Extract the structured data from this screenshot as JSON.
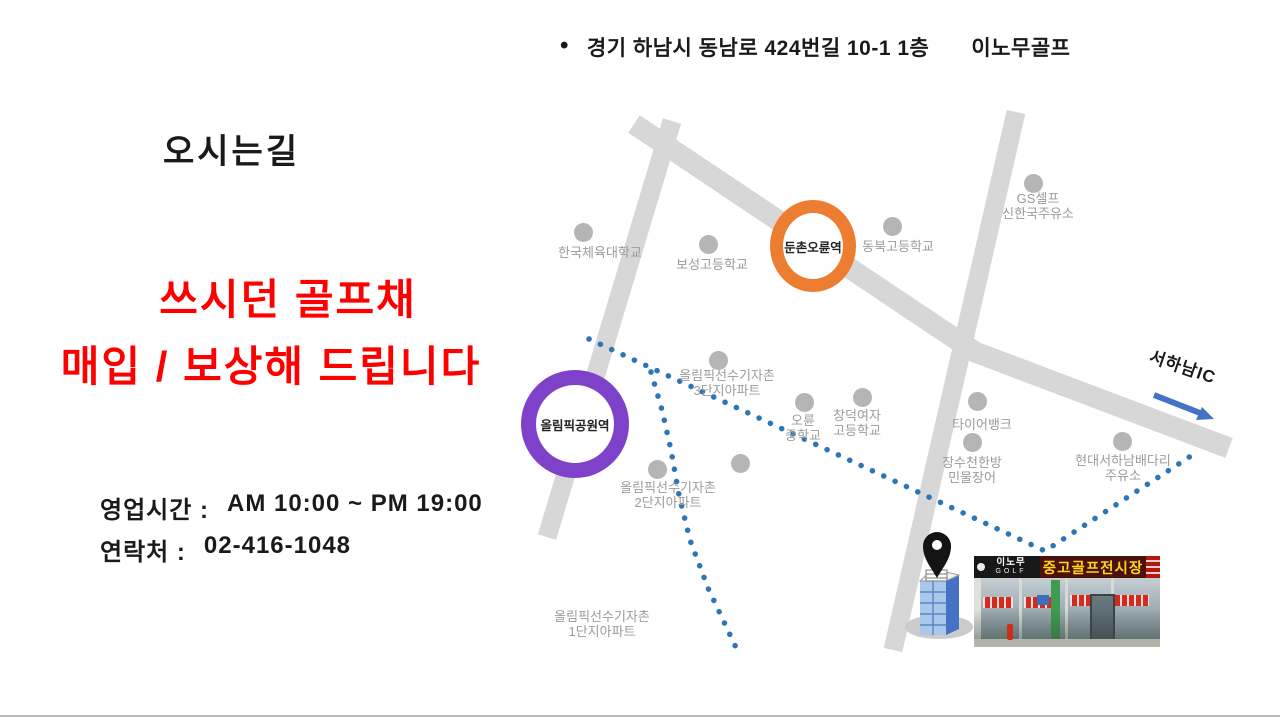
{
  "header": {
    "bullet": "•",
    "address": "경기 하남시 동남로 424번길 10-1 1층",
    "brand": "이노무골프"
  },
  "left_panel": {
    "heading": "오시는길",
    "promo_line1": "쓰시던 골프채",
    "promo_line2": "매입 / 보상해 드립니다",
    "hours_label": "영업시간 :",
    "hours_value": "AM 10:00 ~ PM 19:00",
    "contact_label": "연락처 :",
    "contact_value": "02-416-1048"
  },
  "colors": {
    "promo_red": "#FF0000",
    "road": "#D7D7D7",
    "poi_dot": "#B5B5B5",
    "poi_label": "#9B9B9B",
    "route": "#2E75B6",
    "arrow": "#4472C4",
    "pin": "#141414",
    "ink": "#1A1A1A"
  },
  "map": {
    "roads": [
      {
        "d": "M 672 121 L 547 537"
      },
      {
        "d": "M 634 124 L 975 352 L 1229 448"
      },
      {
        "d": "M 1016 112 L 893 650"
      }
    ],
    "routes": [
      {
        "d": "M 589 339 L 1045 551 L 1197 452"
      },
      {
        "d": "M 651 372 L 662 410 L 671 450 L 679 495 L 690 540 L 708 588 L 724 622 L 740 656"
      }
    ],
    "stations": [
      {
        "name": "둔촌오륜역",
        "cx": 813,
        "cy": 246,
        "rx": 43,
        "ry": 46,
        "ring": 13,
        "color": "#ED7D31"
      },
      {
        "name": "올림픽공원역",
        "cx": 575,
        "cy": 424,
        "rx": 54,
        "ry": 54,
        "ring": 15,
        "color": "#7E41CA"
      }
    ],
    "pois": [
      {
        "label": "한국체육대학교",
        "dot": [
          583,
          232
        ],
        "lx": 600,
        "ly": 246
      },
      {
        "label": "보성고등학교",
        "dot": [
          708,
          244
        ],
        "lx": 712,
        "ly": 258
      },
      {
        "label": "동북고등학교",
        "dot": [
          892,
          226
        ],
        "lx": 898,
        "ly": 240
      },
      {
        "label": "GS셀프\n신한국주유소",
        "dot": [
          1033,
          183
        ],
        "lx": 1038,
        "ly": 192
      },
      {
        "label": "올림픽선수기자촌\n3단지아파트",
        "dot": [
          718,
          360
        ],
        "lx": 727,
        "ly": 369
      },
      {
        "label": "오륜\n중학교",
        "dot": [
          804,
          402
        ],
        "lx": 803,
        "ly": 414
      },
      {
        "label": "창덕여자\n고등학교",
        "dot": [
          862,
          397
        ],
        "lx": 857,
        "ly": 409
      },
      {
        "label": "타이어뱅크",
        "dot": [
          977,
          401
        ],
        "lx": 982,
        "ly": 418
      },
      {
        "label": "장수천한방\n민물장어",
        "dot": [
          972,
          442
        ],
        "lx": 972,
        "ly": 456
      },
      {
        "label": "현대서하남배다리\n주유소",
        "dot": [
          1122,
          441
        ],
        "lx": 1123,
        "ly": 454
      },
      {
        "label": "올림픽선수기자촌\n2단지아파트",
        "dot": [
          657,
          469
        ],
        "lx": 668,
        "ly": 481
      },
      {
        "label": "",
        "dot": [
          740,
          463
        ],
        "lx": 0,
        "ly": 0
      },
      {
        "label": "올림픽선수기자촌\n1단지아파트",
        "dot": null,
        "lx": 602,
        "ly": 610
      }
    ],
    "ic_label": "서하남IC",
    "ic_arrow": {
      "line_d": "M 1154 395 L 1200 413",
      "head_points": "1214,419 1196,420 1202,407"
    },
    "pin_d": "M937,578 C930,566 923,558 923,546 A14,14 0 1 1 951,546 C951,558 944,566 937,578 Z"
  },
  "photo": {
    "sign_brand_line1": "이노무",
    "sign_brand_line2": "GOLF",
    "sign_main": "중고골프전시장"
  }
}
